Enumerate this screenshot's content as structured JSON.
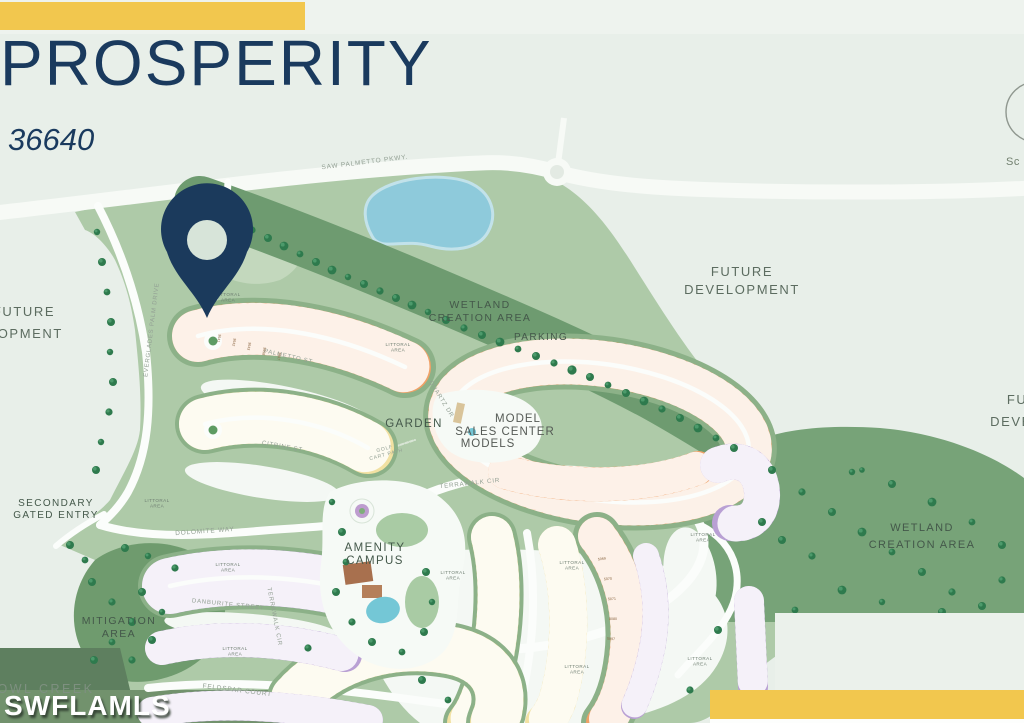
{
  "header": {
    "title": "PROSPERITY",
    "lot_number": "36640"
  },
  "watermark": "SWFLAMLS",
  "scan_partial": "Sc",
  "map": {
    "streets": {
      "saw_palmetto": "SAW PALMETTO PKWY.",
      "everglades_palm": "EVERGLADES PALM DRIVE",
      "dolomite_way": "DOLOMITE WAY",
      "palmetto_st": "PALMETTO ST",
      "citrine_st": "CITRINE ST",
      "quartz_dr": "QUARTZ DR",
      "terrawalk_cir": "TERRAWALK CIR",
      "danburite_st": "DANBURITE STREET",
      "feldspar_ct": "FELDSPAR COURT",
      "golf_cart_line1": "GOLF",
      "golf_cart_line2": "CART PATH"
    },
    "areas": {
      "future_line1": "FUTURE",
      "future_line2": "DEVELOPMENT",
      "wetland_line1": "WETLAND",
      "wetland_line2": "CREATION AREA",
      "parking": "PARKING",
      "garden": "GARDEN",
      "model": "MODEL",
      "sales_center": "SALES CENTER",
      "models": "MODELS",
      "amenity_line1": "AMENITY",
      "amenity_line2": "CAMPUS",
      "secondary_line1": "SECONDARY",
      "secondary_line2": "GATED ENTRY",
      "mitigation_line1": "MITIGATION",
      "mitigation_line2": "AREA",
      "littoral_line1": "LITTORAL",
      "littoral_line2": "AREA",
      "owl_creek": "OWL CREEK"
    },
    "lot_number_samples": [
      "3641",
      "3642",
      "3643",
      "3658",
      "3667",
      "5069",
      "5070",
      "5071",
      "5080",
      "5097",
      "5173",
      "5219"
    ],
    "legend_colors": {
      "single_family_orange": "#EFA167",
      "villa_yellow": "#F2E1A2",
      "townhome_purple": "#B9A0D4",
      "water": "#8ECADB",
      "wetland_green": "#74A076",
      "brand_yellow": "#F2C74E",
      "brand_navy": "#1B3A5C"
    }
  }
}
